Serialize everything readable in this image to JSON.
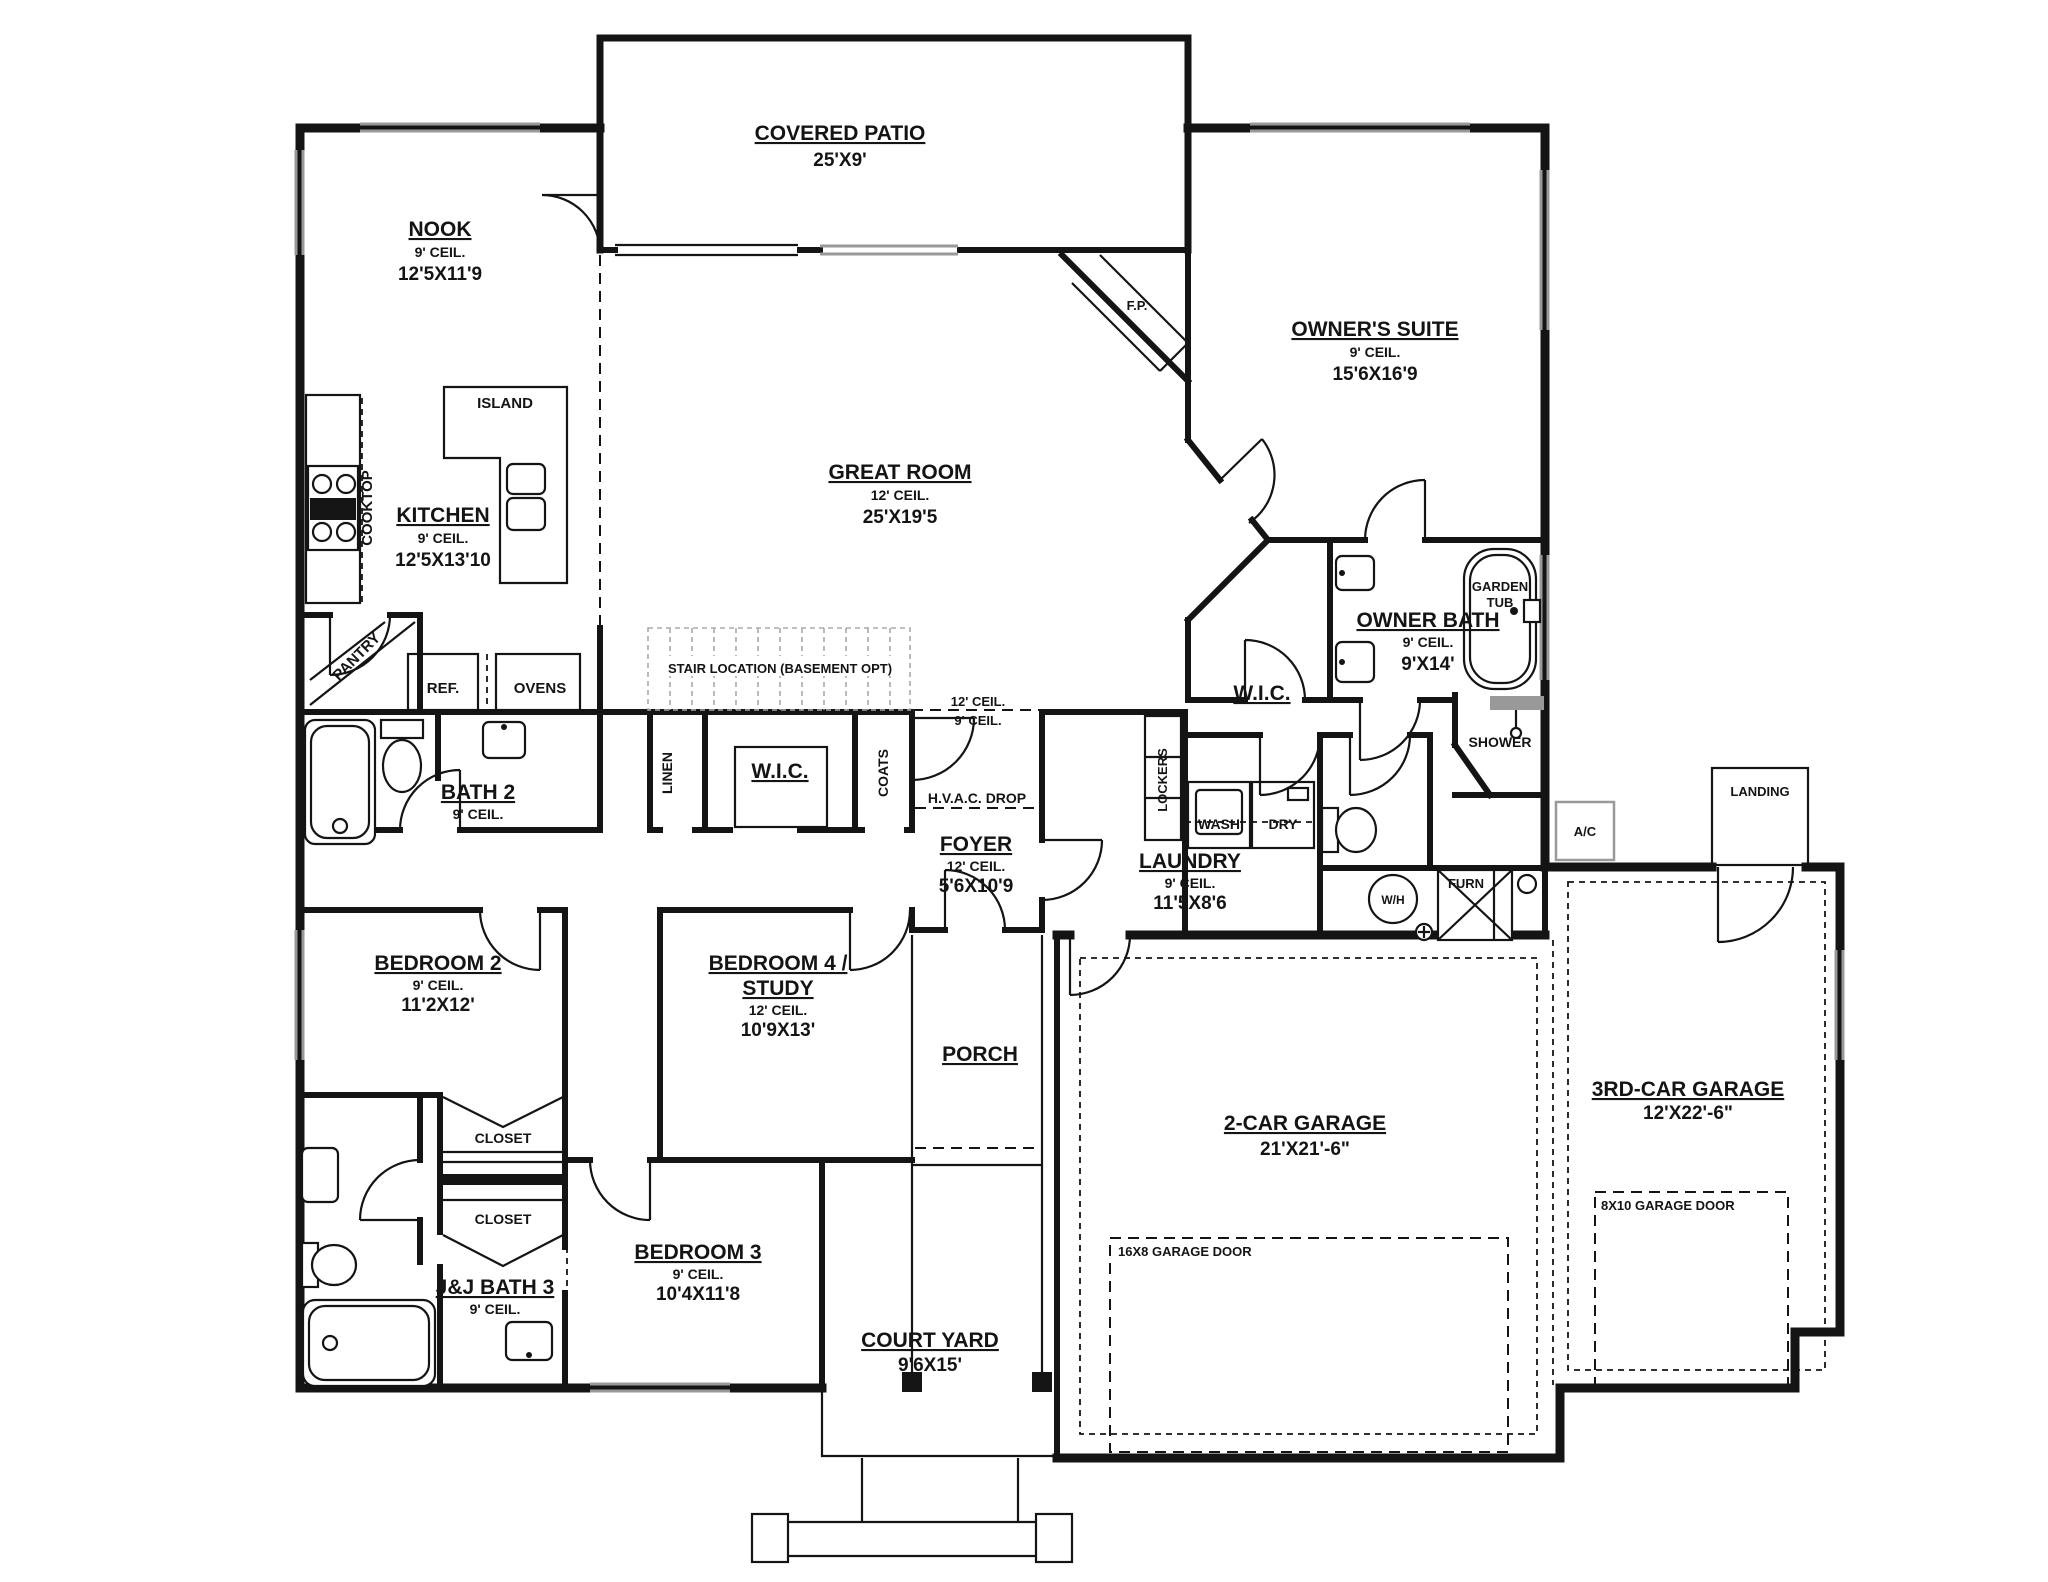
{
  "colors": {
    "wall": "#141414",
    "window_gray": "#999999",
    "background": "#ffffff"
  },
  "labels": {
    "covered_patio": {
      "name": "COVERED PATIO",
      "dims": "25'X9'"
    },
    "nook": {
      "name": "NOOK",
      "ceil": "9' CEIL.",
      "dims": "12'5X11'9"
    },
    "owners_suite": {
      "name": "OWNER'S SUITE",
      "ceil": "9' CEIL.",
      "dims": "15'6X16'9"
    },
    "great_room": {
      "name": "GREAT ROOM",
      "ceil": "12' CEIL.",
      "dims": "25'X19'5"
    },
    "kitchen": {
      "name": "KITCHEN",
      "ceil": "9' CEIL.",
      "dims": "12'5X13'10"
    },
    "island": {
      "name": "ISLAND"
    },
    "cooktop": {
      "name": "COOKTOP"
    },
    "pantry": {
      "name": "PANTRY"
    },
    "ref": {
      "name": "REF."
    },
    "ovens": {
      "name": "OVENS"
    },
    "fireplace": {
      "name": "F.P."
    },
    "stair": {
      "name": "STAIR LOCATION (BASEMENT OPT)"
    },
    "ceil_break": {
      "upper": "12' CEIL.",
      "lower": "9' CEIL."
    },
    "linen": {
      "name": "LINEN"
    },
    "wic_hall": {
      "name": "W.I.C."
    },
    "coats": {
      "name": "COATS"
    },
    "hvac": {
      "name": "H.V.A.C. DROP"
    },
    "foyer": {
      "name": "FOYER",
      "ceil": "12' CEIL.",
      "dims": "5'6X10'9"
    },
    "wic_owner": {
      "name": "W.I.C."
    },
    "owner_bath": {
      "name": "OWNER BATH",
      "ceil": "9' CEIL.",
      "dims": "9'X14'"
    },
    "garden_tub": {
      "line1": "GARDEN",
      "line2": "TUB"
    },
    "shower": {
      "name": "SHOWER"
    },
    "bath2": {
      "name": "BATH 2",
      "ceil": "9' CEIL."
    },
    "lockers": {
      "name": "LOCKERS"
    },
    "wash": {
      "name": "WASH"
    },
    "dry": {
      "name": "DRY"
    },
    "laundry": {
      "name": "LAUNDRY",
      "ceil": "9' CEIL.",
      "dims": "11'5X8'6"
    },
    "water_heater": {
      "name": "W/H"
    },
    "furnace": {
      "name": "FURN"
    },
    "ac": {
      "name": "A/C"
    },
    "landing": {
      "name": "LANDING"
    },
    "bedroom2": {
      "name": "BEDROOM 2",
      "ceil": "9' CEIL.",
      "dims": "11'2X12'"
    },
    "bedroom4": {
      "name1": "BEDROOM 4 /",
      "name2": "STUDY",
      "ceil": "12' CEIL.",
      "dims": "10'9X13'"
    },
    "porch": {
      "name": "PORCH"
    },
    "garage2": {
      "name": "2-CAR GARAGE",
      "dims": "21'X21'-6\""
    },
    "garage3": {
      "name": "3RD-CAR GARAGE",
      "dims": "12'X22'-6\""
    },
    "garage_door_16x8": {
      "name": "16X8 GARAGE DOOR"
    },
    "garage_door_8x10": {
      "name": "8X10 GARAGE DOOR"
    },
    "closet1": {
      "name": "CLOSET"
    },
    "closet2": {
      "name": "CLOSET"
    },
    "jj_bath3": {
      "name": "J&J BATH 3",
      "ceil": "9' CEIL."
    },
    "bedroom3": {
      "name": "BEDROOM 3",
      "ceil": "9' CEIL.",
      "dims": "10'4X11'8"
    },
    "court_yard": {
      "name": "COURT YARD",
      "dims": "9'6X15'"
    }
  }
}
